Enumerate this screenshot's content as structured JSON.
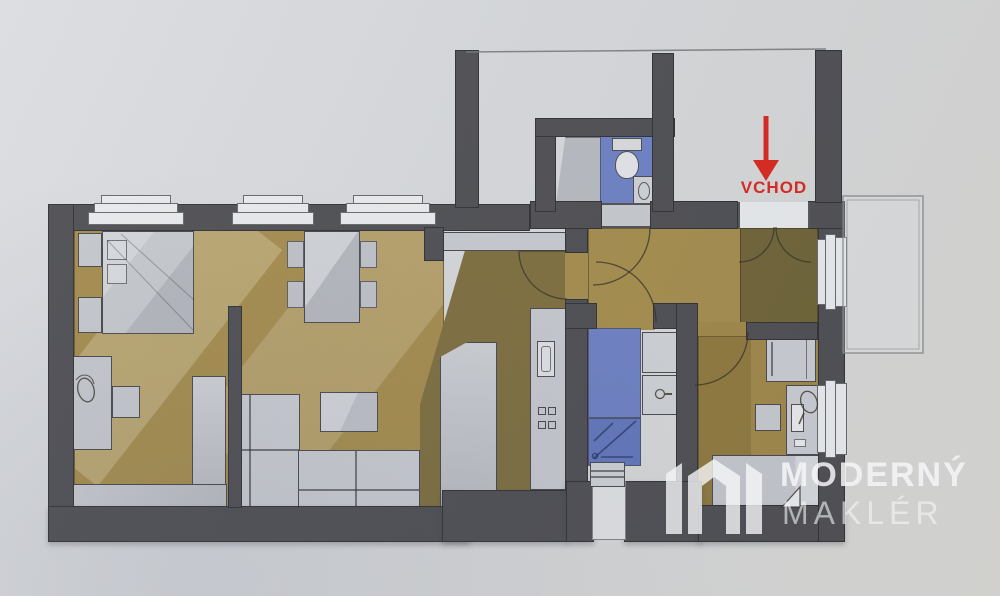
{
  "labels": {
    "entrance": "VCHOD"
  },
  "watermark": {
    "brand_line1": "MODERNÝ",
    "brand_line2": "MAKLÉR"
  },
  "colors": {
    "paper": "#d7d9dc",
    "wall": "#4e4e52",
    "floor_main": "#a58c4c",
    "floor_kitchen": "#7e6e3d",
    "floor_entry": "#6f6336",
    "floor_bedroom2": "#a08748",
    "tile_blue": "#6d80c2",
    "shower_blue": "#6176bb",
    "furniture": "#c6c9ce",
    "window": "#e9ebed",
    "arrow_red": "#d9271e",
    "watermark_white": "#ffffff"
  }
}
